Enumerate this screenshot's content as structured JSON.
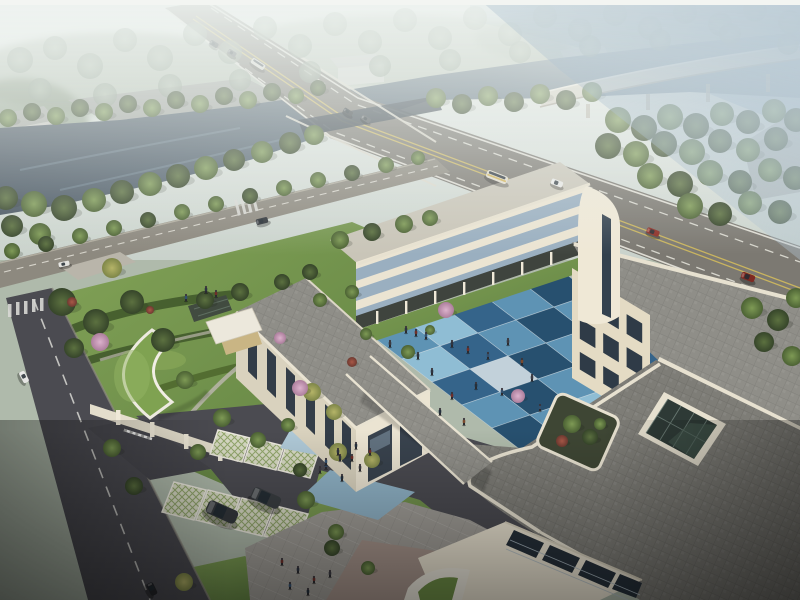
{
  "meta": {
    "title": "aerial-architectural-rendering",
    "subject": "Modern cream-stone institutional building complex with blue-tiled courtyard, seen from high aerial view; river, highway bridge and curved overpass behind; gardens, gated parking and plazas in front",
    "time_of_day": "hazy late afternoon"
  },
  "palette": {
    "skyTop": "#F0F3F0",
    "skyLow": "#D8E0DC",
    "distantLand": "#AFBAAB",
    "farWater": "#AFC2CE",
    "river": "#4C5A68",
    "riverLight": "#8AA0B0",
    "road": "#7C7972",
    "roadEdge": "#E9E7DE",
    "laneYellow": "#C9B45F",
    "bridgeRail": "#DDD9CC",
    "underBridge": "#37414B",
    "ramp": "#D7D2C5",
    "rampEdge": "#EFEAE0",
    "street": "#8D897F",
    "asphalt": "#4B4B51",
    "sidewalk": "#B9B5AA",
    "lawn": "#7FA051",
    "lawnDark": "#5E7F40",
    "hedge": "#47602F",
    "lawnBright": "#8FAE5C",
    "facade": "#EBE4D2",
    "facadeShade": "#D9D2BE",
    "facadeWarm": "#E4DBC4",
    "parapet": "#E7E1D0",
    "window": "#2F3B47",
    "windowBlue": "#9AAFC0",
    "glassDark": "#2E3A36",
    "glassMull": "#6E7E78",
    "roofLight": "#C9C5B8",
    "roofPaver": "#8F8E88",
    "roofPaverDark": "#7E7D77",
    "colonnade": "#3F443E",
    "courtBlue1": "#5E93B4",
    "courtBlue2": "#35648A",
    "courtBlue3": "#27506F",
    "courtBlue4": "#8FBDD4",
    "courtPale": "#C2D1DA",
    "plaza": "#A09D97",
    "plazaBlue": "#AFC9D7",
    "plazaBlue2": "#8FB2C6",
    "tanPave": "#A6948B",
    "tanCourt": "#C9B584",
    "lattice": "#D8DAC4",
    "latticeLine": "#93A86C",
    "planterSoil": "#3E4634",
    "greenRoof": "#7FA251",
    "warehouseRoof": "#9FA29D",
    "warehouseWall": "#C4C4BE",
    "carRed": "#8C2F26",
    "carDark": "#34383C",
    "carWhite": "#E8E8E6",
    "busStripe": "#D2B258",
    "shadow": "#1C2416"
  },
  "courtyard": {
    "origin": [
      372,
      336
    ],
    "u": [
      38,
      -13
    ],
    "v": [
      30,
      23
    ],
    "rows": [
      [
        "courtBlue1",
        "courtBlue4",
        "courtBlue2",
        "courtBlue1",
        "courtBlue3"
      ],
      [
        "courtBlue4",
        "courtBlue2",
        "courtBlue1",
        "courtBlue3",
        "courtBlue1"
      ],
      [
        "courtBlue2",
        "courtPale",
        "courtBlue3",
        "courtBlue1",
        "courtBlue4"
      ],
      [
        "courtBlue1",
        "courtBlue3",
        "courtBlue1",
        "courtBlue4",
        "courtBlue2"
      ],
      [
        "courtBlue3",
        "courtBlue1",
        "courtBlue4",
        "courtBlue2",
        "courtBlue1"
      ]
    ]
  },
  "scene": {
    "trees": [
      [
        20,
        60,
        13,
        "h"
      ],
      [
        55,
        48,
        12,
        "h"
      ],
      [
        90,
        66,
        13,
        "h"
      ],
      [
        125,
        40,
        12,
        "h"
      ],
      [
        160,
        58,
        13,
        "h"
      ],
      [
        195,
        34,
        12,
        "h"
      ],
      [
        230,
        52,
        12,
        "h"
      ],
      [
        265,
        28,
        12,
        "h"
      ],
      [
        300,
        46,
        12,
        "h"
      ],
      [
        335,
        24,
        12,
        "h"
      ],
      [
        370,
        42,
        12,
        "h"
      ],
      [
        405,
        20,
        12,
        "h"
      ],
      [
        440,
        38,
        12,
        "h"
      ],
      [
        475,
        18,
        12,
        "h"
      ],
      [
        510,
        34,
        12,
        "h"
      ],
      [
        545,
        16,
        12,
        "h"
      ],
      [
        580,
        30,
        12,
        "h"
      ],
      [
        615,
        14,
        12,
        "h"
      ],
      [
        650,
        28,
        12,
        "h"
      ],
      [
        685,
        12,
        12,
        "h"
      ],
      [
        720,
        24,
        12,
        "h"
      ],
      [
        755,
        10,
        12,
        "h"
      ],
      [
        790,
        22,
        12,
        "h"
      ],
      [
        40,
        90,
        12,
        "h"
      ],
      [
        105,
        95,
        12,
        "h"
      ],
      [
        170,
        86,
        12,
        "h"
      ],
      [
        240,
        80,
        11,
        "h"
      ],
      [
        310,
        72,
        11,
        "h"
      ],
      [
        380,
        66,
        11,
        "h"
      ],
      [
        450,
        60,
        11,
        "h"
      ],
      [
        520,
        52,
        11,
        "h"
      ],
      [
        590,
        46,
        11,
        "h"
      ],
      [
        660,
        40,
        11,
        "h"
      ],
      [
        730,
        34,
        11,
        "h"
      ],
      [
        788,
        44,
        11,
        "h"
      ],
      [
        8,
        118,
        9,
        "g"
      ],
      [
        32,
        112,
        9,
        "d"
      ],
      [
        56,
        116,
        9,
        "g"
      ],
      [
        80,
        108,
        9,
        "d"
      ],
      [
        104,
        112,
        9,
        "g"
      ],
      [
        128,
        104,
        9,
        "d"
      ],
      [
        152,
        108,
        9,
        "g"
      ],
      [
        176,
        100,
        9,
        "d"
      ],
      [
        200,
        104,
        9,
        "g"
      ],
      [
        224,
        96,
        9,
        "d"
      ],
      [
        248,
        100,
        9,
        "g"
      ],
      [
        272,
        92,
        9,
        "d"
      ],
      [
        296,
        96,
        8,
        "g"
      ],
      [
        318,
        88,
        8,
        "d"
      ],
      [
        6,
        198,
        12,
        "d"
      ],
      [
        34,
        204,
        13,
        "g"
      ],
      [
        64,
        208,
        13,
        "d"
      ],
      [
        94,
        200,
        12,
        "g"
      ],
      [
        122,
        192,
        12,
        "d"
      ],
      [
        150,
        184,
        12,
        "g"
      ],
      [
        178,
        176,
        12,
        "d"
      ],
      [
        206,
        168,
        12,
        "g"
      ],
      [
        234,
        160,
        11,
        "d"
      ],
      [
        262,
        152,
        11,
        "g"
      ],
      [
        290,
        143,
        11,
        "d"
      ],
      [
        314,
        135,
        10,
        "g"
      ],
      [
        12,
        226,
        11,
        "d"
      ],
      [
        40,
        234,
        11,
        "g"
      ],
      [
        436,
        98,
        10,
        "g"
      ],
      [
        462,
        104,
        10,
        "d"
      ],
      [
        488,
        96,
        10,
        "g"
      ],
      [
        514,
        102,
        10,
        "d"
      ],
      [
        540,
        94,
        10,
        "g"
      ],
      [
        566,
        100,
        10,
        "d"
      ],
      [
        592,
        92,
        10,
        "g"
      ],
      [
        618,
        120,
        13,
        "g"
      ],
      [
        644,
        128,
        13,
        "d"
      ],
      [
        670,
        117,
        13,
        "g"
      ],
      [
        696,
        126,
        13,
        "d"
      ],
      [
        722,
        114,
        12,
        "g"
      ],
      [
        748,
        122,
        12,
        "d"
      ],
      [
        774,
        111,
        12,
        "g"
      ],
      [
        796,
        120,
        12,
        "d"
      ],
      [
        608,
        146,
        13,
        "d"
      ],
      [
        636,
        154,
        13,
        "g"
      ],
      [
        664,
        144,
        13,
        "d"
      ],
      [
        692,
        152,
        13,
        "g"
      ],
      [
        720,
        141,
        12,
        "d"
      ],
      [
        748,
        150,
        12,
        "g"
      ],
      [
        776,
        139,
        12,
        "d"
      ],
      [
        650,
        176,
        13,
        "g"
      ],
      [
        680,
        184,
        13,
        "d"
      ],
      [
        710,
        173,
        13,
        "g"
      ],
      [
        740,
        182,
        12,
        "d"
      ],
      [
        770,
        170,
        12,
        "g"
      ],
      [
        795,
        178,
        12,
        "d"
      ],
      [
        690,
        206,
        13,
        "g"
      ],
      [
        720,
        214,
        12,
        "d"
      ],
      [
        750,
        203,
        12,
        "g"
      ],
      [
        780,
        212,
        12,
        "d"
      ],
      [
        752,
        308,
        11,
        "g"
      ],
      [
        778,
        320,
        11,
        "d"
      ],
      [
        796,
        298,
        10,
        "g"
      ],
      [
        764,
        342,
        10,
        "d"
      ],
      [
        792,
        356,
        10,
        "g"
      ],
      [
        12,
        251,
        8,
        "g"
      ],
      [
        46,
        244,
        8,
        "d"
      ],
      [
        80,
        236,
        8,
        "g"
      ],
      [
        114,
        228,
        8,
        "g"
      ],
      [
        148,
        220,
        8,
        "d"
      ],
      [
        182,
        212,
        8,
        "g"
      ],
      [
        216,
        204,
        8,
        "g"
      ],
      [
        250,
        196,
        8,
        "d"
      ],
      [
        284,
        188,
        8,
        "g"
      ],
      [
        318,
        180,
        8,
        "g"
      ],
      [
        352,
        173,
        8,
        "d"
      ],
      [
        386,
        165,
        8,
        "g"
      ],
      [
        418,
        158,
        7,
        "g"
      ],
      [
        340,
        240,
        9,
        "g"
      ],
      [
        372,
        232,
        9,
        "d"
      ],
      [
        404,
        224,
        9,
        "g"
      ],
      [
        430,
        218,
        8,
        "g"
      ],
      [
        62,
        302,
        14,
        "d"
      ],
      [
        96,
        322,
        13,
        "d"
      ],
      [
        132,
        302,
        12,
        "d"
      ],
      [
        163,
        340,
        12,
        "d"
      ],
      [
        74,
        348,
        10,
        "d"
      ],
      [
        205,
        300,
        9,
        "d"
      ],
      [
        240,
        292,
        9,
        "d"
      ],
      [
        282,
        282,
        8,
        "d"
      ],
      [
        310,
        272,
        8,
        "d"
      ],
      [
        185,
        380,
        9,
        "g"
      ],
      [
        222,
        418,
        9,
        "g"
      ],
      [
        258,
        440,
        8,
        "g"
      ],
      [
        198,
        452,
        8,
        "g"
      ],
      [
        288,
        425,
        7,
        "g"
      ],
      [
        320,
        300,
        7,
        "g"
      ],
      [
        352,
        292,
        7,
        "g"
      ],
      [
        112,
        268,
        10,
        "y"
      ],
      [
        338,
        452,
        9,
        "y"
      ],
      [
        372,
        460,
        8,
        "y"
      ],
      [
        312,
        392,
        9,
        "y"
      ],
      [
        334,
        412,
        8,
        "y"
      ],
      [
        184,
        582,
        9,
        "y"
      ],
      [
        100,
        342,
        9,
        "p"
      ],
      [
        300,
        388,
        8,
        "p"
      ],
      [
        446,
        310,
        8,
        "p"
      ],
      [
        518,
        396,
        7,
        "p"
      ],
      [
        280,
        338,
        6,
        "p"
      ],
      [
        72,
        302,
        5,
        "r"
      ],
      [
        352,
        362,
        5,
        "r"
      ],
      [
        150,
        310,
        4,
        "r"
      ],
      [
        408,
        352,
        7,
        "g"
      ],
      [
        366,
        334,
        6,
        "g"
      ],
      [
        430,
        330,
        5,
        "g"
      ],
      [
        572,
        424,
        9,
        "g"
      ],
      [
        600,
        424,
        6,
        "g"
      ],
      [
        112,
        448,
        9,
        "g"
      ],
      [
        306,
        500,
        9,
        "g"
      ],
      [
        336,
        532,
        8,
        "g"
      ],
      [
        300,
        470,
        7,
        "d"
      ],
      [
        368,
        568,
        7,
        "g"
      ],
      [
        590,
        437,
        8,
        "d"
      ],
      [
        134,
        486,
        9,
        "d"
      ],
      [
        332,
        548,
        8,
        "d"
      ],
      [
        562,
        441,
        6,
        "r"
      ]
    ],
    "people": [
      [
        452,
        344,
        "#2E3440"
      ],
      [
        468,
        350,
        "#6E2F2A"
      ],
      [
        488,
        356,
        "#33506E"
      ],
      [
        508,
        342,
        "#3B3B42"
      ],
      [
        522,
        362,
        "#7A4A2E"
      ],
      [
        476,
        386,
        "#24303C"
      ],
      [
        452,
        396,
        "#6E2F2A"
      ],
      [
        432,
        372,
        "#2E3440"
      ],
      [
        502,
        392,
        "#33506E"
      ],
      [
        532,
        378,
        "#3B3B42"
      ],
      [
        440,
        412,
        "#24303C"
      ],
      [
        464,
        422,
        "#7A4A2E"
      ],
      [
        418,
        356,
        "#2E3440"
      ],
      [
        540,
        408,
        "#33506E"
      ],
      [
        406,
        330,
        "#2E3440"
      ],
      [
        416,
        333,
        "#6E2F2A"
      ],
      [
        426,
        336,
        "#33506E"
      ],
      [
        390,
        344,
        "#3B3B42"
      ],
      [
        356,
        446,
        "#24303C"
      ],
      [
        370,
        452,
        "#6E2F2A"
      ],
      [
        340,
        458,
        "#2E3440"
      ],
      [
        326,
        466,
        "#33506E"
      ],
      [
        360,
        468,
        "#3B3B42"
      ],
      [
        338,
        452,
        "#2E3440"
      ],
      [
        352,
        458,
        "#6E2F2A"
      ],
      [
        326,
        462,
        "#33506E"
      ],
      [
        342,
        478,
        "#24303C"
      ],
      [
        320,
        470,
        "#3B3B42"
      ],
      [
        298,
        570,
        "#2E3440"
      ],
      [
        314,
        580,
        "#6E2F2A"
      ],
      [
        290,
        586,
        "#33506E"
      ],
      [
        330,
        574,
        "#3B3B42"
      ],
      [
        308,
        592,
        "#24303C"
      ],
      [
        282,
        562,
        "#6E2F2A"
      ],
      [
        206,
        290,
        "#2E3440"
      ],
      [
        216,
        294,
        "#6E2F2A"
      ],
      [
        186,
        298,
        "#33506E"
      ]
    ],
    "cars": [
      [
        214,
        44,
        33,
        9,
        5,
        "#3A4044",
        "car"
      ],
      [
        232,
        53,
        33,
        9,
        5,
        "#565B5F",
        "car"
      ],
      [
        258,
        64,
        33,
        15,
        6,
        "#DAD9D2",
        "bus"
      ],
      [
        348,
        112,
        33,
        10,
        5,
        "#33383C",
        "car"
      ],
      [
        366,
        119,
        33,
        10,
        5,
        "#4A4F53",
        "car"
      ],
      [
        497,
        177,
        21,
        22,
        8,
        "#E2DDCF",
        "busY"
      ],
      [
        557,
        183,
        21,
        12,
        6,
        "#E8E8E6",
        "car"
      ],
      [
        653,
        232,
        21,
        13,
        6,
        "#8C2F26",
        "car"
      ],
      [
        748,
        277,
        21,
        14,
        7,
        "#7E2A22",
        "car"
      ],
      [
        262,
        221,
        -14,
        12,
        6,
        "#2E3338",
        "car"
      ],
      [
        64,
        264,
        -12,
        11,
        5,
        "#E2E2DE",
        "car"
      ],
      [
        24,
        377,
        62,
        12,
        6,
        "#E6E6E4",
        "car"
      ],
      [
        152,
        589,
        64,
        13,
        7,
        "#24262A",
        "car"
      ],
      [
        222,
        512,
        24,
        32,
        14,
        "#34383C",
        "suv"
      ],
      [
        266,
        498,
        24,
        30,
        13,
        "#3A3E42",
        "suv"
      ]
    ]
  }
}
